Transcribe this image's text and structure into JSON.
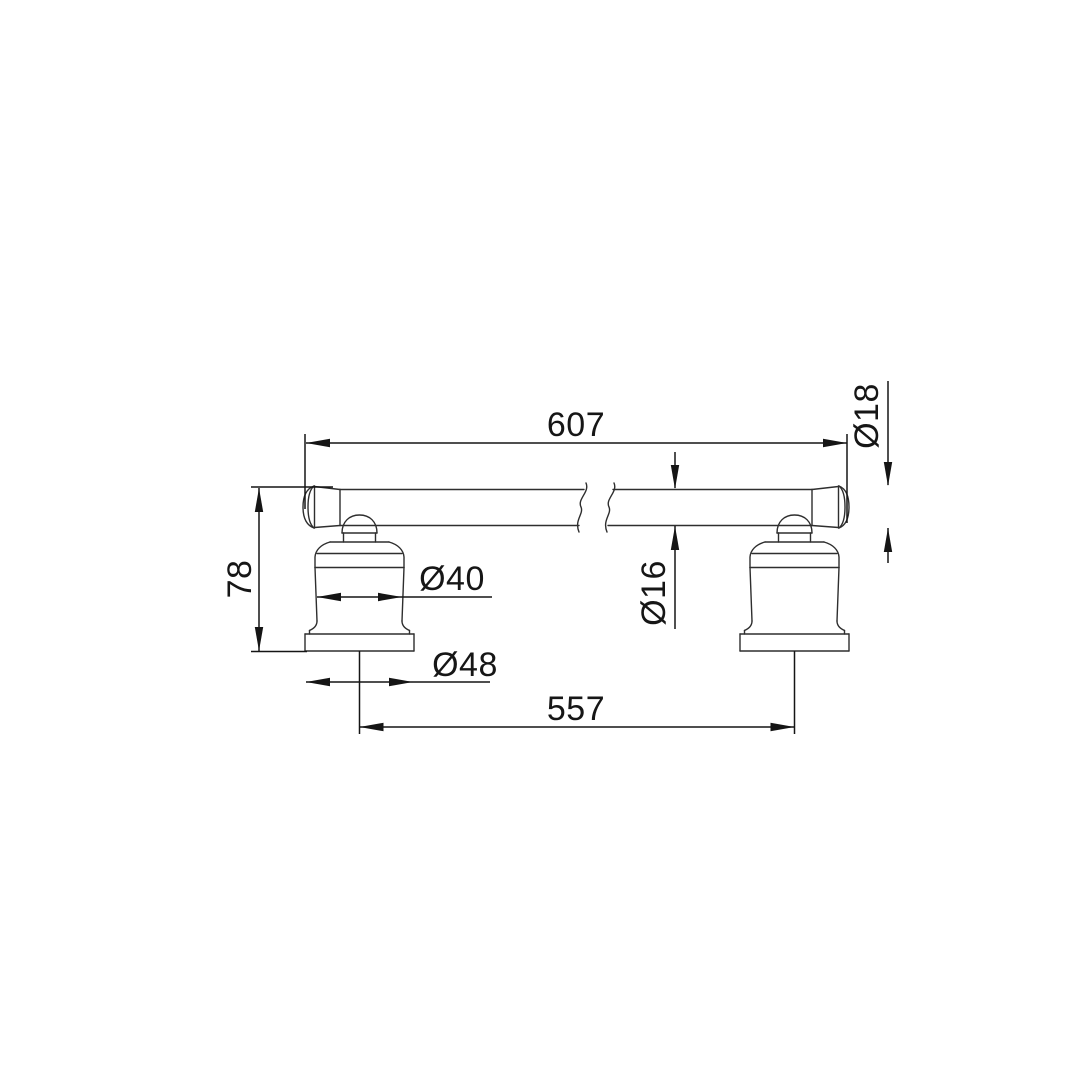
{
  "drawing": {
    "kind": "technical dimension drawing",
    "subject": "wall-mounted towel rail with two bell-shaped posts",
    "units": "mm",
    "colors": {
      "background": "#ffffff",
      "line": "#2e2e2e",
      "dimension": "#151515"
    },
    "dimensions": {
      "overall_length": "607",
      "end_cap_diameter": "Ø18",
      "rail_diameter": "Ø16",
      "post_height": "78",
      "post_body_diameter": "Ø40",
      "base_flange_diameter": "Ø48",
      "fixing_centres": "557"
    }
  }
}
